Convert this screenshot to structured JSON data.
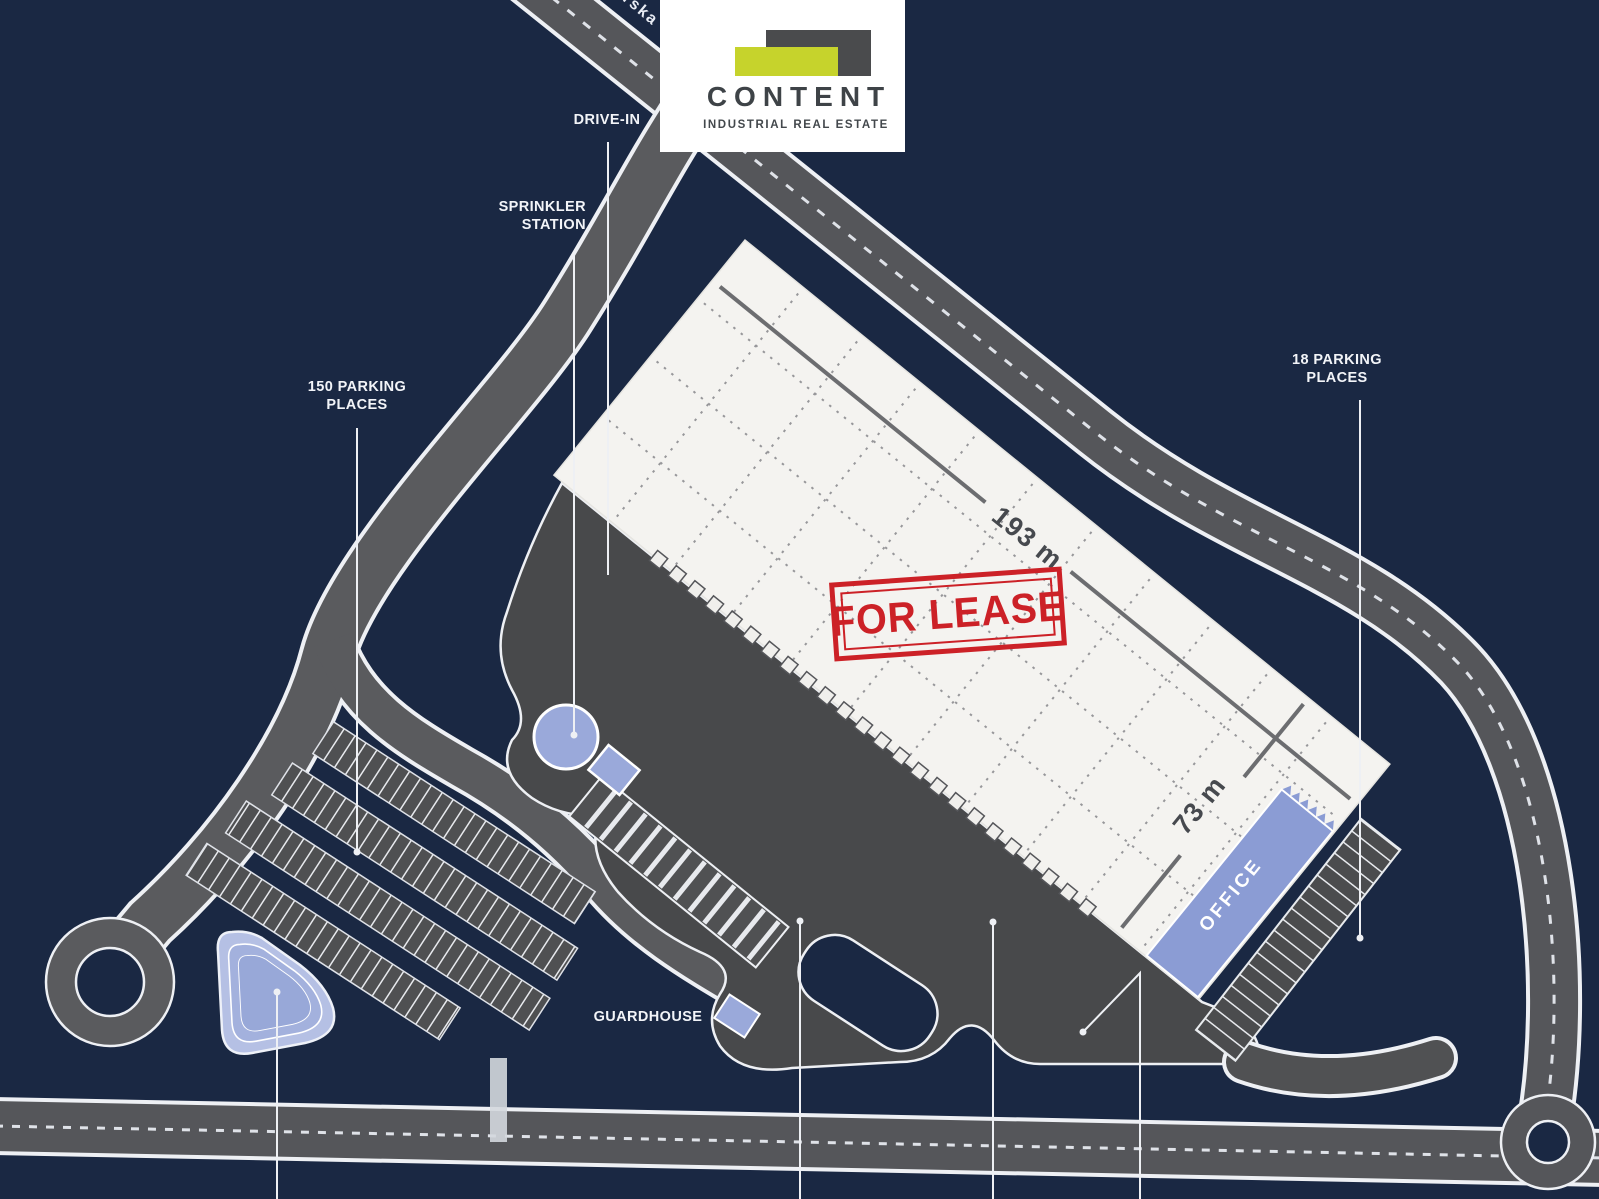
{
  "page_title": "Industrial park site plan - warehouse for lease",
  "logo": {
    "brand": "CONTENT",
    "tagline": "INDUSTRIAL REAL ESTATE",
    "lime_color": "#c6d32c",
    "gray_color": "#4a4b4d"
  },
  "stamp": {
    "text": "FOR LEASE",
    "color": "#cc2127"
  },
  "street_label_fragment": "rska",
  "building": {
    "length_label": "193 m",
    "width_label": "73 m",
    "office_label": "OFFICE"
  },
  "labels": {
    "drive_in": "DRIVE-IN",
    "sprinkler_line1": "SPRINKLER",
    "sprinkler_line2": "STATION",
    "parking150_line1": "150 PARKING",
    "parking150_line2": "PLACES",
    "parking18_line1": "18 PARKING",
    "parking18_line2": "PLACES",
    "guardhouse": "GUARDHOUSE"
  },
  "colors": {
    "background_navy": "#1a2843",
    "public_road": "#55565a",
    "internal_road": "#5a5b5e",
    "apron": "#48494b",
    "building_white": "#f4f3f0",
    "accent_blue": "#94a3d6",
    "line_white": "#eef0f4",
    "stamp_red": "#cc2127"
  }
}
